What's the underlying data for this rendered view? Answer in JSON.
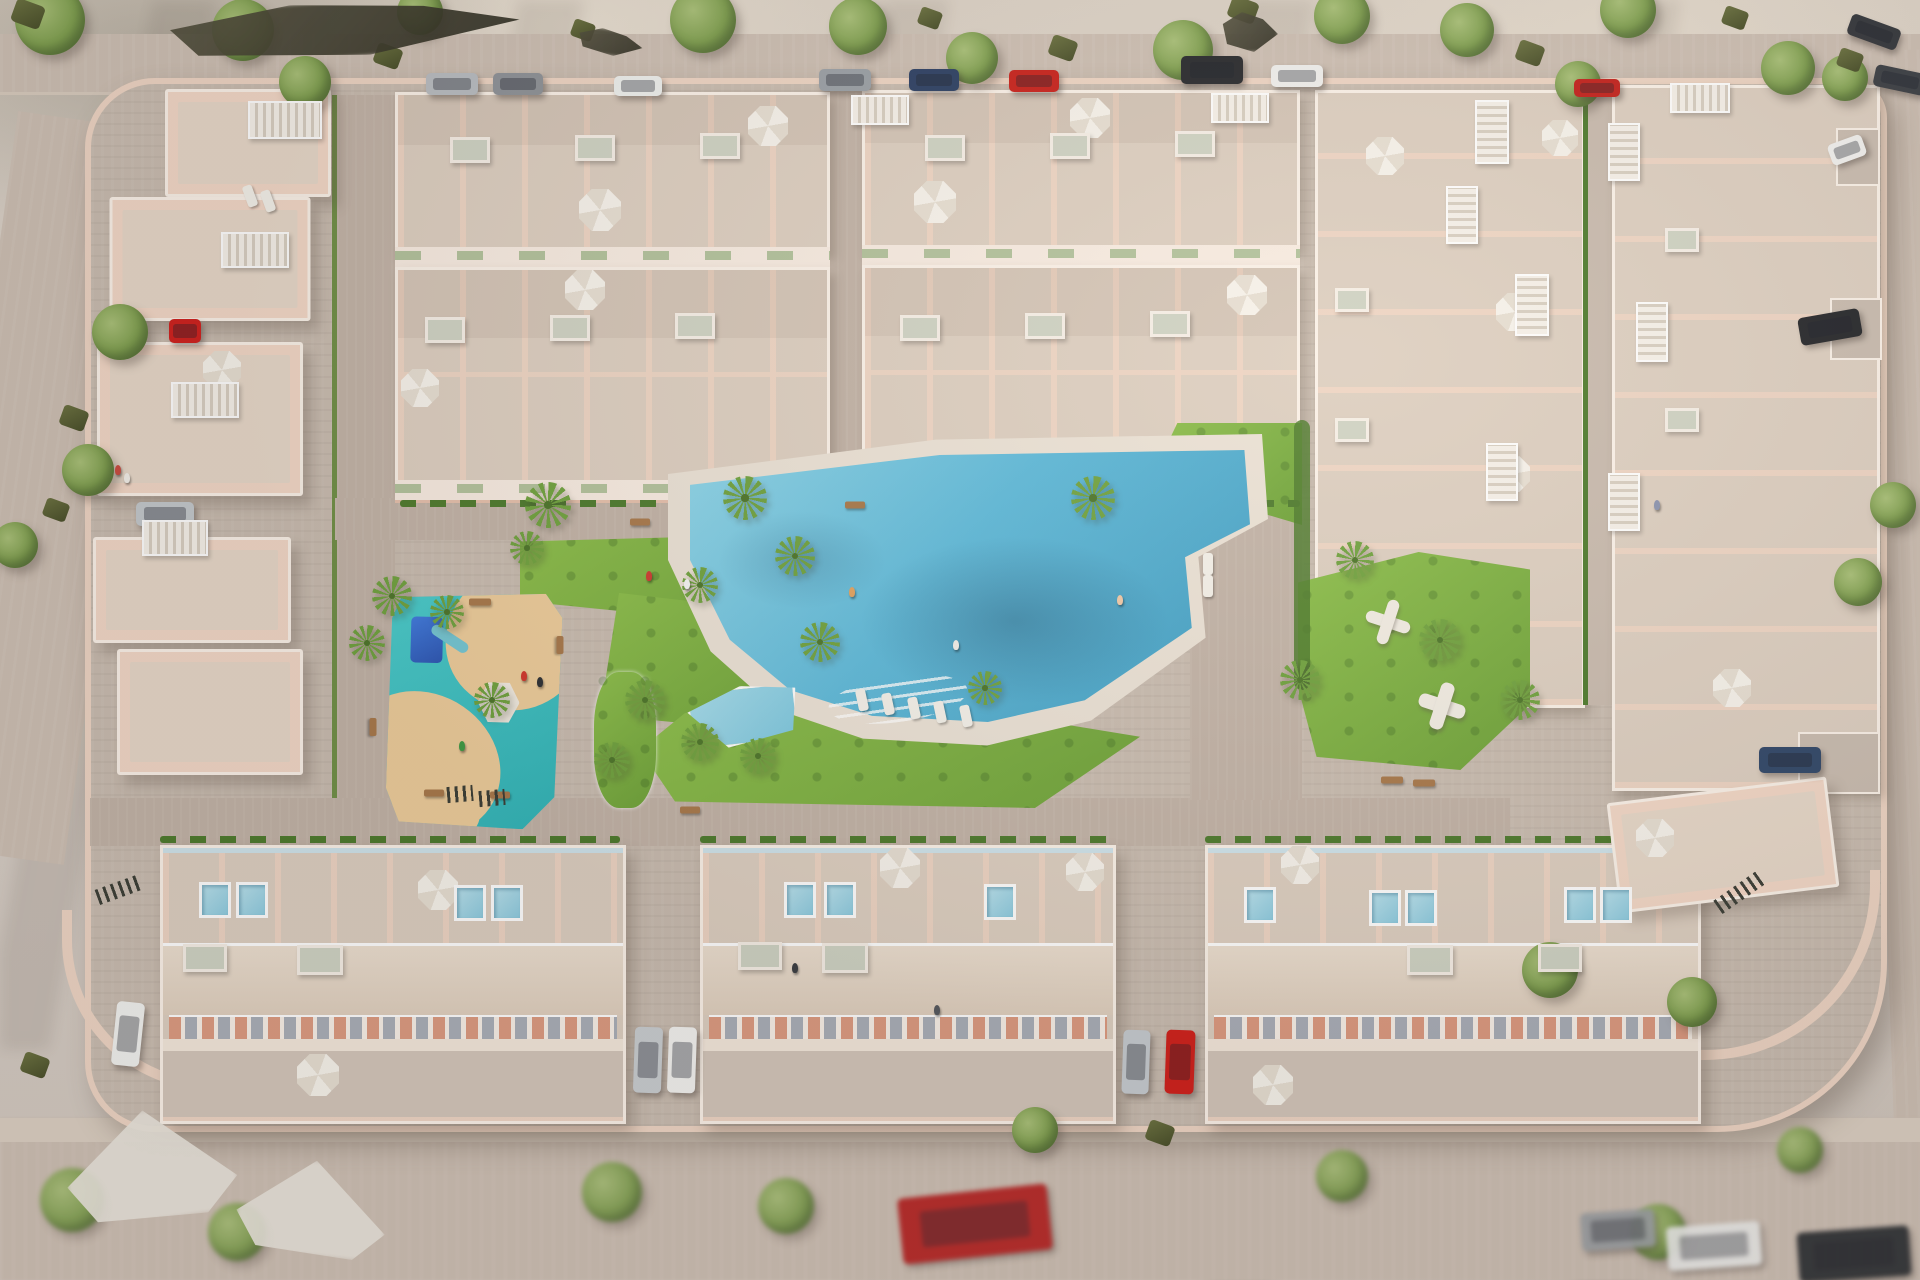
{
  "palette": {
    "ground": "#d8d0c8",
    "ground_lt": "#e6dcd1",
    "road": "#cdbfb3",
    "sidewalk": "#dbcfc2",
    "paving": "#c9bcb0",
    "paving_lt": "#d3c6ba",
    "street": "#c2b3a7",
    "wall": "#eed5c4",
    "wall_edge": "#fbf2e9",
    "bld": "#f3d8c7",
    "bld_mid": "#e5c0ac",
    "bld_roof": "#e7d8c9",
    "terr": "#ddcfc1",
    "facade": "#f8ece2",
    "awning": "#b2c29c",
    "glass": "#cfe4ec",
    "lawn": "#7cb23e",
    "lawn_dk": "#619434",
    "hedge": "#4c7a2c",
    "deck": "#ebe2d6",
    "pool": "#58b6d8",
    "pool_dk": "#3e9cc2",
    "pool_kid": "#8ed4e8",
    "pg": "#3fc6c6",
    "sand": "#eecd9b",
    "play": "#2f6bd8",
    "tree": "#7fa04f",
    "tree_dk": "#5c7c39",
    "palm": "#6fa23e",
    "bush": "#5a6135",
    "umb": "#f6f2ea",
    "umb2": "#e7dfd3",
    "wood": "#a8784a",
    "white": "#f7f3ec"
  },
  "objects": {
    "trees": [
      [
        50,
        20,
        70
      ],
      [
        243,
        30,
        62
      ],
      [
        420,
        12,
        46
      ],
      [
        703,
        20,
        66
      ],
      [
        858,
        26,
        58
      ],
      [
        972,
        58,
        52
      ],
      [
        1183,
        50,
        60
      ],
      [
        1342,
        16,
        56
      ],
      [
        1467,
        30,
        54
      ],
      [
        1628,
        10,
        56
      ],
      [
        1788,
        68,
        54
      ],
      [
        1845,
        78,
        46
      ],
      [
        1578,
        84,
        46
      ],
      [
        305,
        82,
        52
      ],
      [
        120,
        332,
        56
      ],
      [
        88,
        470,
        52
      ],
      [
        15,
        545,
        46
      ],
      [
        1893,
        505,
        46
      ],
      [
        1858,
        582,
        48
      ],
      [
        1550,
        970,
        56
      ],
      [
        1692,
        1002,
        50
      ],
      [
        1035,
        1130,
        46
      ],
      [
        72,
        1200,
        64
      ],
      [
        237,
        1232,
        58
      ],
      [
        612,
        1192,
        60
      ],
      [
        786,
        1206,
        56
      ],
      [
        1342,
        1176,
        52
      ],
      [
        1658,
        1232,
        56
      ],
      [
        1800,
        1150,
        46
      ]
    ],
    "palms": [
      [
        548,
        505,
        46
      ],
      [
        745,
        498,
        44
      ],
      [
        795,
        556,
        40
      ],
      [
        700,
        585,
        36
      ],
      [
        820,
        642,
        40
      ],
      [
        392,
        596,
        40
      ],
      [
        367,
        643,
        36
      ],
      [
        1093,
        498,
        44
      ],
      [
        645,
        700,
        40
      ],
      [
        700,
        742,
        38
      ],
      [
        758,
        756,
        36
      ],
      [
        985,
        688,
        34
      ],
      [
        1300,
        680,
        40
      ],
      [
        1440,
        640,
        42
      ],
      [
        1520,
        700,
        40
      ],
      [
        612,
        760,
        36
      ],
      [
        492,
        700,
        36
      ],
      [
        1355,
        560,
        38
      ],
      [
        447,
        612,
        34
      ],
      [
        527,
        548,
        34
      ]
    ],
    "bushes": [
      [
        28,
        14,
        30
      ],
      [
        388,
        56,
        26
      ],
      [
        1063,
        48,
        26
      ],
      [
        1243,
        10,
        28
      ],
      [
        1530,
        53,
        26
      ],
      [
        74,
        418,
        26
      ],
      [
        56,
        510,
        24
      ],
      [
        1160,
        1133,
        26
      ],
      [
        1850,
        60,
        24
      ],
      [
        583,
        30,
        22
      ],
      [
        1735,
        18,
        24
      ],
      [
        35,
        1065,
        26
      ],
      [
        930,
        18,
        22
      ]
    ],
    "cars": [
      [
        452,
        84,
        52,
        22,
        0,
        "#b9bdc2"
      ],
      [
        518,
        84,
        50,
        22,
        0,
        "#8e9298"
      ],
      [
        638,
        86,
        48,
        20,
        0,
        "#eef0ee"
      ],
      [
        845,
        80,
        52,
        22,
        0,
        "#9aa0a6"
      ],
      [
        934,
        80,
        50,
        22,
        0,
        "#2b3f63"
      ],
      [
        1034,
        81,
        50,
        22,
        0,
        "#c8201a"
      ],
      [
        1212,
        70,
        62,
        28,
        0,
        "#26282c"
      ],
      [
        1297,
        76,
        52,
        22,
        0,
        "#f0f0ee"
      ],
      [
        1597,
        88,
        46,
        18,
        0,
        "#c31f1a"
      ],
      [
        1874,
        32,
        52,
        22,
        20,
        "#33363b"
      ],
      [
        1900,
        80,
        52,
        22,
        12,
        "#3a3e44"
      ],
      [
        185,
        331,
        32,
        24,
        0,
        "#cf1f1c"
      ],
      [
        165,
        514,
        58,
        24,
        0,
        "#c3c8cc"
      ],
      [
        128,
        1034,
        28,
        64,
        6,
        "#f1f1ef"
      ],
      [
        648,
        1060,
        28,
        66,
        2,
        "#c9cdd1"
      ],
      [
        682,
        1060,
        28,
        66,
        2,
        "#f2f2f0"
      ],
      [
        1136,
        1062,
        27,
        64,
        2,
        "#c6cbd0"
      ],
      [
        1180,
        1062,
        29,
        64,
        2,
        "#d01f1a"
      ],
      [
        1790,
        760,
        62,
        26,
        0,
        "#2f4668"
      ],
      [
        1847,
        150,
        36,
        22,
        -20,
        "#f1f1ef"
      ],
      [
        1830,
        327,
        62,
        28,
        -10,
        "#24262a"
      ],
      [
        975,
        1224,
        150,
        66,
        -6,
        "#b71f1f"
      ],
      [
        1618,
        1230,
        74,
        38,
        -4,
        "#9b9fa3"
      ],
      [
        1714,
        1246,
        94,
        44,
        -4,
        "#ececea"
      ],
      [
        1854,
        1254,
        112,
        50,
        -4,
        "#2a2d31"
      ]
    ],
    "umbrellas": [
      [
        600,
        210,
        42
      ],
      [
        768,
        126,
        40
      ],
      [
        585,
        290,
        40
      ],
      [
        420,
        388,
        38
      ],
      [
        935,
        202,
        42
      ],
      [
        1090,
        118,
        40
      ],
      [
        1247,
        295,
        40
      ],
      [
        1385,
        156,
        38
      ],
      [
        1560,
        138,
        36
      ],
      [
        1515,
        312,
        38
      ],
      [
        1512,
        474,
        36
      ],
      [
        1732,
        688,
        38
      ],
      [
        438,
        890,
        40
      ],
      [
        900,
        868,
        40
      ],
      [
        1085,
        872,
        38
      ],
      [
        1300,
        865,
        38
      ],
      [
        318,
        1075,
        42
      ],
      [
        1273,
        1085,
        40
      ],
      [
        222,
        370,
        38
      ],
      [
        1655,
        838,
        38
      ]
    ],
    "jacks": [
      [
        1388,
        622,
        46
      ],
      [
        1442,
        706,
        48
      ]
    ],
    "loungers": [
      [
        862,
        700,
        -12
      ],
      [
        888,
        704,
        -12
      ],
      [
        914,
        708,
        -12
      ],
      [
        940,
        712,
        -12
      ],
      [
        966,
        716,
        -12
      ],
      [
        250,
        196,
        -20
      ],
      [
        268,
        201,
        -20
      ],
      [
        1208,
        564,
        0
      ],
      [
        1208,
        586,
        0
      ]
    ],
    "benches": [
      [
        480,
        602,
        22,
        0
      ],
      [
        373,
        727,
        18,
        90
      ],
      [
        560,
        645,
        18,
        90
      ],
      [
        500,
        795,
        20,
        0
      ],
      [
        434,
        793,
        20,
        0
      ],
      [
        1392,
        780,
        22,
        0
      ],
      [
        1424,
        783,
        22,
        0
      ],
      [
        855,
        505,
        20,
        0
      ],
      [
        640,
        522,
        20,
        0
      ],
      [
        690,
        810,
        20,
        0
      ]
    ],
    "skylights": [
      [
        470,
        150,
        34,
        20
      ],
      [
        595,
        148,
        34,
        20
      ],
      [
        720,
        146,
        34,
        20
      ],
      [
        445,
        330,
        34,
        20
      ],
      [
        570,
        328,
        34,
        20
      ],
      [
        695,
        326,
        34,
        20
      ],
      [
        945,
        148,
        34,
        20
      ],
      [
        1070,
        146,
        34,
        20
      ],
      [
        1195,
        144,
        34,
        20
      ],
      [
        920,
        328,
        34,
        20
      ],
      [
        1045,
        326,
        34,
        20
      ],
      [
        1170,
        324,
        34,
        20
      ],
      [
        1352,
        300,
        28,
        18
      ],
      [
        1352,
        430,
        28,
        18
      ],
      [
        1682,
        240,
        28,
        18
      ],
      [
        1682,
        420,
        28,
        18
      ],
      [
        320,
        960,
        40,
        24
      ],
      [
        845,
        958,
        40,
        24
      ],
      [
        1430,
        960,
        40,
        24
      ],
      [
        205,
        958,
        38,
        22
      ],
      [
        1560,
        958,
        38,
        22
      ],
      [
        760,
        956,
        38,
        22
      ]
    ],
    "plunge_pools": [
      [
        215,
        900
      ],
      [
        252,
        900
      ],
      [
        470,
        903
      ],
      [
        507,
        903
      ],
      [
        800,
        900
      ],
      [
        840,
        900
      ],
      [
        1000,
        902
      ],
      [
        1260,
        905
      ],
      [
        1385,
        908
      ],
      [
        1421,
        908
      ],
      [
        1580,
        905
      ],
      [
        1616,
        905
      ]
    ],
    "people": [
      [
        649,
        576,
        "#cf3a30"
      ],
      [
        687,
        584,
        "#f5f5f5"
      ],
      [
        852,
        592,
        "#e2a25f"
      ],
      [
        524,
        676,
        "#d2352b"
      ],
      [
        540,
        682,
        "#2c2f33"
      ],
      [
        462,
        746,
        "#3f9b44"
      ],
      [
        1120,
        600,
        "#f0c9a8"
      ],
      [
        956,
        645,
        "#f3efe9"
      ],
      [
        118,
        470,
        "#c84a3f"
      ],
      [
        127,
        478,
        "#f2efe9"
      ],
      [
        1657,
        505,
        "#8a93b0"
      ],
      [
        795,
        968,
        "#3a3d42"
      ],
      [
        937,
        1010,
        "#55585e"
      ]
    ],
    "louvers": [
      [
        285,
        120,
        70,
        34
      ],
      [
        255,
        250,
        64,
        32
      ],
      [
        205,
        400,
        64,
        32
      ],
      [
        175,
        538,
        62,
        32
      ],
      [
        1492,
        132,
        30,
        60
      ],
      [
        1462,
        215,
        28,
        54
      ],
      [
        1532,
        305,
        30,
        58
      ],
      [
        1502,
        472,
        28,
        54
      ],
      [
        1624,
        152,
        28,
        54
      ],
      [
        1652,
        332,
        28,
        56
      ],
      [
        1624,
        502,
        28,
        54
      ],
      [
        1700,
        98,
        56,
        26
      ],
      [
        880,
        110,
        54,
        26
      ],
      [
        1240,
        108,
        54,
        26
      ]
    ],
    "racks": [
      [
        118,
        890,
        44,
        -20
      ],
      [
        1740,
        892,
        54,
        -35
      ],
      [
        460,
        794,
        26,
        -5
      ],
      [
        492,
        798,
        26,
        -5
      ]
    ],
    "tents": [
      [
        150,
        1165,
        170,
        110,
        -8
      ],
      [
        312,
        1208,
        150,
        95,
        6
      ]
    ],
    "patches": [
      [
        330,
        30,
        380,
        55,
        -4
      ],
      [
        608,
        42,
        70,
        26,
        8
      ],
      [
        1248,
        32,
        60,
        40,
        0
      ]
    ],
    "buildings": [
      [
        168,
        92,
        160,
        102,
        0
      ],
      [
        112,
        200,
        195,
        118,
        0
      ],
      [
        100,
        345,
        200,
        148,
        0
      ],
      [
        96,
        540,
        192,
        100,
        0
      ],
      [
        120,
        652,
        180,
        120,
        0
      ],
      [
        1615,
        792,
        215,
        105,
        -7
      ]
    ]
  }
}
